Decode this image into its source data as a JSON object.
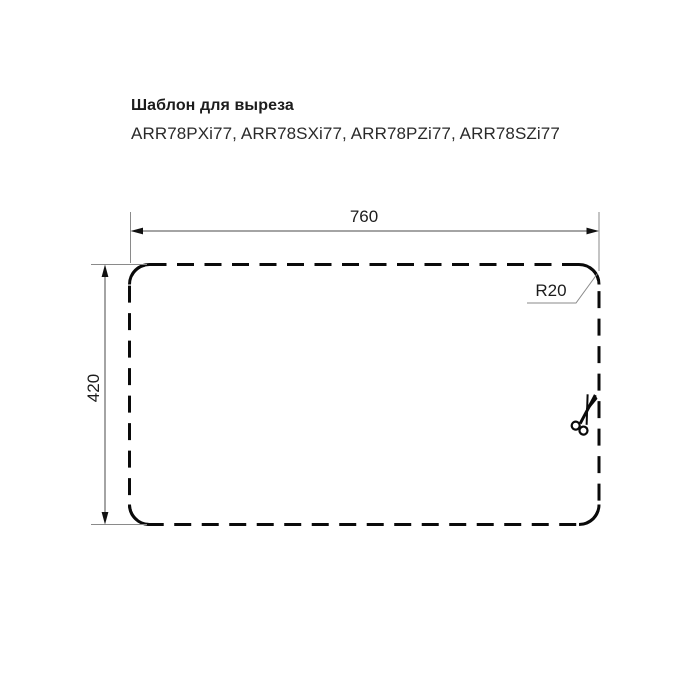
{
  "header": {
    "title": "Шаблон для выреза",
    "models": "ARR78PXi77, ARR78SXi77, ARR78PZi77, ARR78SZi77"
  },
  "diagram": {
    "type": "sink-cutout-template",
    "cutout": {
      "width_mm": 760,
      "height_mm": 420,
      "corner_radius_mm": 20,
      "outline_style": "dashed"
    },
    "labels": {
      "width": "760",
      "height": "420",
      "radius": "R20"
    },
    "icons": {
      "scissors": "cut-along-dashed-line"
    },
    "colors": {
      "outline": "#0a0a0a",
      "dimension_line": "#4a4a4a",
      "extension_line": "#8a8a8a",
      "text": "#1c1c1c",
      "background": "#ffffff"
    }
  }
}
